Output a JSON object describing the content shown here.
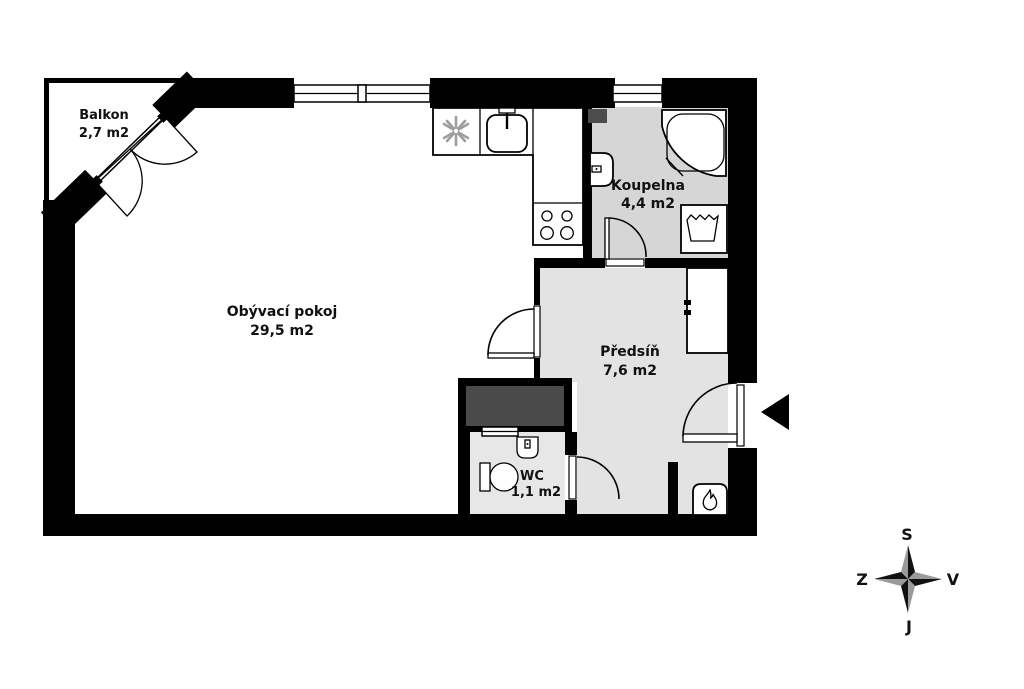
{
  "rooms": {
    "balcony": {
      "name": "Balkon",
      "area": "2,7 m2"
    },
    "living_room": {
      "name": "Obývací pokoj",
      "area": "29,5 m2"
    },
    "bathroom": {
      "name": "Koupelna",
      "area": "4,4 m2"
    },
    "hallway": {
      "name": "Předsíň",
      "area": "7,6 m2"
    },
    "wc": {
      "name": "WC",
      "area": "1,1 m2"
    }
  },
  "compass": {
    "north": "S",
    "south": "J",
    "east": "V",
    "west": "Z"
  },
  "fixtures": [
    "extractor-fan",
    "kitchen-sink",
    "cooktop",
    "corner-shower",
    "washbasin",
    "washing-machine",
    "toilet",
    "wc-sink",
    "wardrobe",
    "gas-boiler",
    "entrance-arrow",
    "compass-rose"
  ],
  "colors": {
    "wall": "#000000",
    "bathroom_floor": "#d6d6d6",
    "hallway_floor": "#e3e3e3",
    "wc_floor": "#e7e7e7",
    "shaft_fill": "#4a4a4a",
    "duct_fill": "#4d4d4d",
    "label_color": "#111111",
    "compass_dark": "#111111",
    "compass_light": "#9a9a9a"
  }
}
